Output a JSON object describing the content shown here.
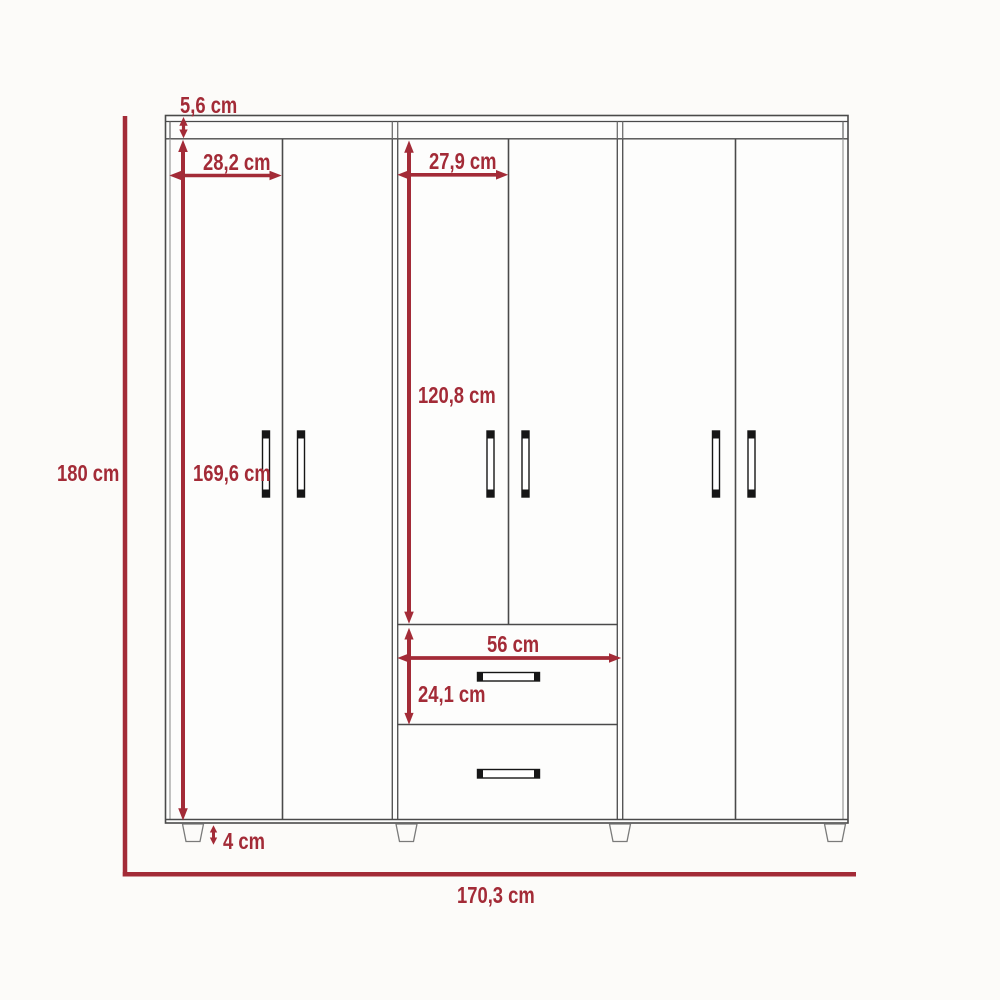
{
  "diagram": {
    "type": "furniture-dimension-diagram",
    "subject": "six-door wardrobe with two center drawers",
    "unit": "cm"
  },
  "colors": {
    "dimension_red": "#a32b37",
    "outline_gray": "#4a4a4a"
  },
  "dimensions": {
    "top_panel_height": {
      "label": "5,6 cm",
      "value": 5.6
    },
    "left_door_width": {
      "label": "28,2 cm",
      "value": 28.2
    },
    "center_door_width": {
      "label": "27,9 cm",
      "value": 27.9
    },
    "overall_height": {
      "label": "180 cm",
      "value": 180
    },
    "door_height": {
      "label": "169,6 cm",
      "value": 169.6
    },
    "center_upper_door_height": {
      "label": "120,8 cm",
      "value": 120.8
    },
    "drawer_width": {
      "label": "56 cm",
      "value": 56
    },
    "drawer_height": {
      "label": "24,1 cm",
      "value": 24.1
    },
    "leg_height": {
      "label": "4 cm",
      "value": 4
    },
    "overall_width": {
      "label": "170,3 cm",
      "value": 170.3
    }
  }
}
